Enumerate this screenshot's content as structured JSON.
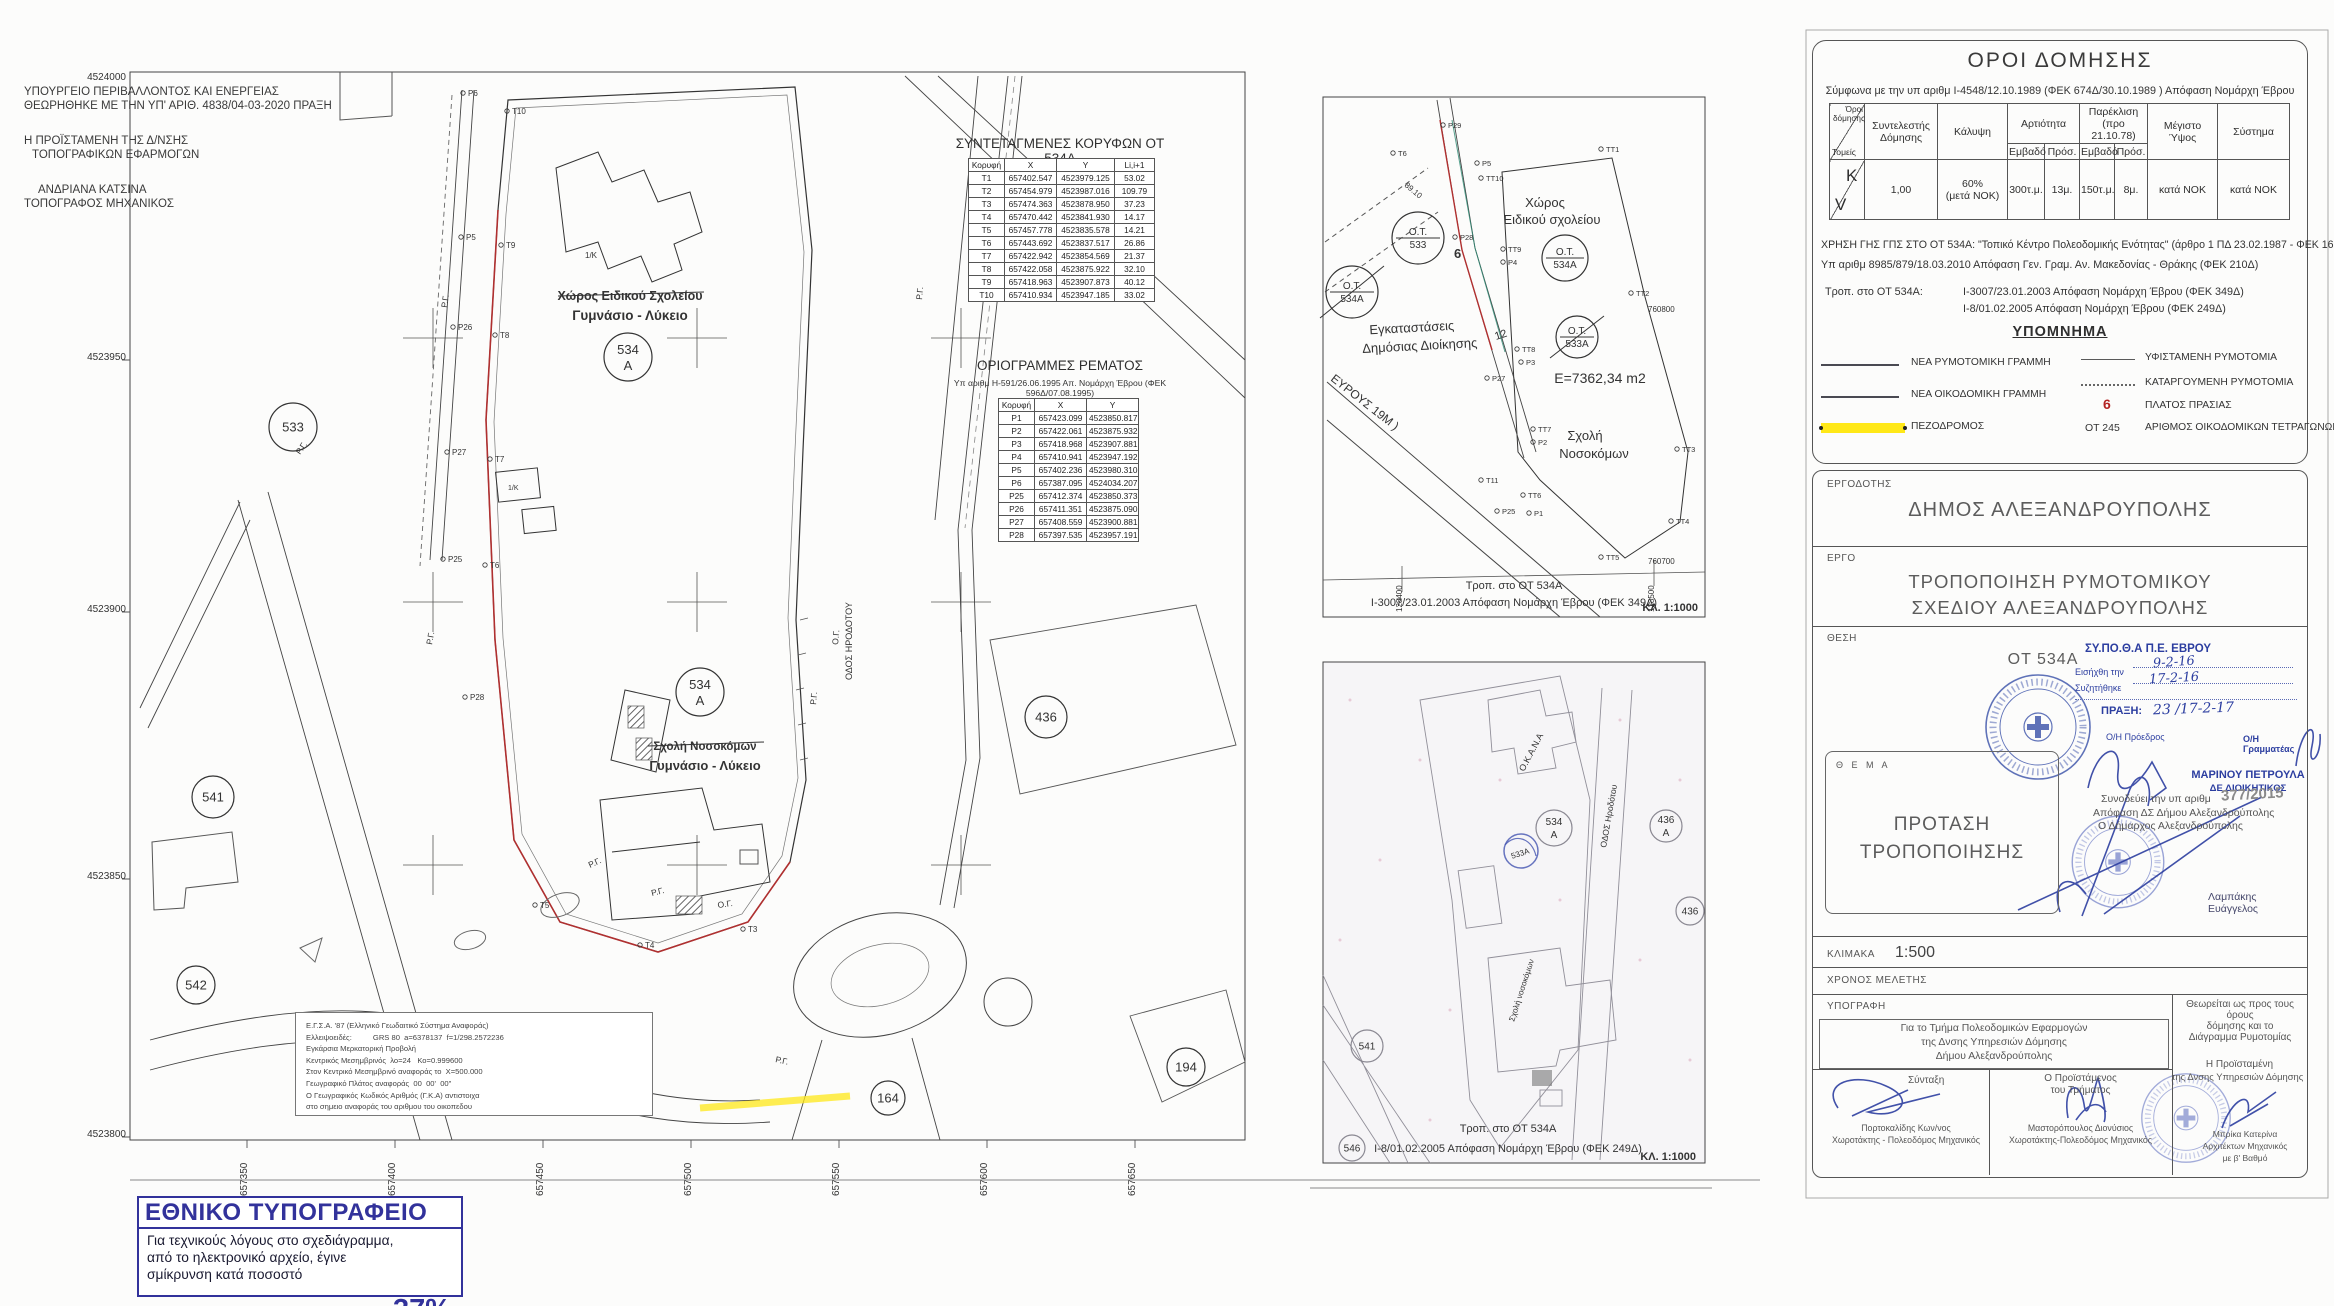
{
  "colors": {
    "accent_red": "#a82828",
    "stamp_blue": "#2c3ea0",
    "np_blue": "#32329b",
    "pezodromos_yellow": "#ffe818"
  },
  "approval": {
    "line1": "ΥΠΟΥΡΓΕΙΟ ΠΕΡΙΒΑΛΛΟΝΤΟΣ ΚΑΙ ΕΝΕΡΓΕΙΑΣ",
    "line2": "ΘΕΩΡΗΘΗΚΕ ΜΕ ΤΗΝ ΥΠ' ΑΡΙΘ. 4838/04-03-2020 ΠΡΑΞΗ",
    "role1": "Η ΠΡΟΪΣΤΑΜΕΝΗ ΤΗΣ Δ/ΝΣΗΣ",
    "role2": "ΤΟΠΟΓΡΑΦΙΚΩΝ ΕΦΑΡΜΟΓΩΝ",
    "name": "ΑΝΔΡΙΑΝΑ ΚΑΤΣΙΝΑ",
    "name_role": "ΤΟΠΟΓΡΑΦΟΣ ΜΗΧΑΝΙΚΟΣ"
  },
  "coord_table": {
    "title": "ΣΥΝΤΕΤΑΓΜΕΝΕΣ ΚΟΡΥΦΩΝ ΟΤ 534Α",
    "headers": [
      "Κορυφή",
      "X",
      "Y",
      "Li,i+1"
    ],
    "rows": [
      [
        "T1",
        "657402.547",
        "4523979.125",
        "53.02"
      ],
      [
        "T2",
        "657454.979",
        "4523987.016",
        "109.79"
      ],
      [
        "T3",
        "657474.363",
        "4523878.950",
        "37.23"
      ],
      [
        "T4",
        "657470.442",
        "4523841.930",
        "14.17"
      ],
      [
        "T5",
        "657457.778",
        "4523835.578",
        "14.21"
      ],
      [
        "T6",
        "657443.692",
        "4523837.517",
        "26.86"
      ],
      [
        "T7",
        "657422.942",
        "4523854.569",
        "21.37"
      ],
      [
        "T8",
        "657422.058",
        "4523875.922",
        "32.10"
      ],
      [
        "T9",
        "657418.963",
        "4523907.873",
        "40.12"
      ],
      [
        "T10",
        "657410.934",
        "4523947.185",
        "33.02"
      ]
    ]
  },
  "stream_table": {
    "title": "ΟΡΙΟΓΡΑΜΜΕΣ ΡΕΜΑΤΟΣ",
    "subtitle": "Υπ αριθμ Η-591/26.06.1995 Απ. Νομάρχη Έβρου  (ΦΕΚ 596Δ/07.08.1995)",
    "headers": [
      "Κορυφή",
      "X",
      "Y"
    ],
    "rows": [
      [
        "P1",
        "657423.099",
        "4523850.817"
      ],
      [
        "P2",
        "657422.061",
        "4523875.932"
      ],
      [
        "P3",
        "657418.968",
        "4523907.881"
      ],
      [
        "P4",
        "657410.941",
        "4523947.192"
      ],
      [
        "P5",
        "657402.236",
        "4523980.310"
      ],
      [
        "P6",
        "657387.095",
        "4524034.207"
      ],
      [
        "P25",
        "657412.374",
        "4523850.373"
      ],
      [
        "P26",
        "657411.351",
        "4523875.090"
      ],
      [
        "P27",
        "657408.559",
        "4523900.881"
      ],
      [
        "P28",
        "657397.535",
        "4523957.191"
      ]
    ]
  },
  "main_map": {
    "axis_left": [
      {
        "x": 126,
        "y": 80,
        "l": "4524000"
      },
      {
        "x": 126,
        "y": 360,
        "l": "4523950"
      },
      {
        "x": 126,
        "y": 612,
        "l": "4523900"
      },
      {
        "x": 126,
        "y": 879,
        "l": "4523850"
      },
      {
        "x": 126,
        "y": 1137,
        "l": "4523800"
      }
    ],
    "axis_bottom": [
      {
        "x": 247,
        "y": 1196,
        "l": "657350"
      },
      {
        "x": 395,
        "y": 1196,
        "l": "657400"
      },
      {
        "x": 543,
        "y": 1196,
        "l": "657450"
      },
      {
        "x": 691,
        "y": 1196,
        "l": "657500"
      },
      {
        "x": 839,
        "y": 1196,
        "l": "657550"
      },
      {
        "x": 987,
        "y": 1196,
        "l": "657600"
      },
      {
        "x": 1135,
        "y": 1196,
        "l": "657650"
      }
    ],
    "circles": [
      {
        "x": 293,
        "y": 427,
        "r": 24,
        "l1": "533"
      },
      {
        "x": 628,
        "y": 357,
        "r": 24,
        "l1": "534",
        "l2": "Α"
      },
      {
        "x": 700,
        "y": 692,
        "r": 24,
        "l1": "534",
        "l2": "Α"
      },
      {
        "x": 213,
        "y": 797,
        "r": 21,
        "l1": "541"
      },
      {
        "x": 1046,
        "y": 717,
        "r": 21,
        "l1": "436"
      },
      {
        "x": 1186,
        "y": 1067,
        "r": 19,
        "l1": "194"
      },
      {
        "x": 888,
        "y": 1098,
        "r": 17,
        "l1": "164"
      },
      {
        "x": 196,
        "y": 985,
        "r": 19,
        "l1": "542"
      }
    ],
    "points": [
      {
        "x": 468,
        "y": 96,
        "l": "P6"
      },
      {
        "x": 512,
        "y": 114,
        "l": "T10"
      },
      {
        "x": 466,
        "y": 240,
        "l": "P5"
      },
      {
        "x": 506,
        "y": 248,
        "l": "T9"
      },
      {
        "x": 458,
        "y": 330,
        "l": "P26"
      },
      {
        "x": 500,
        "y": 338,
        "l": "T8"
      },
      {
        "x": 452,
        "y": 455,
        "l": "P27"
      },
      {
        "x": 495,
        "y": 462,
        "l": "T7"
      },
      {
        "x": 448,
        "y": 562,
        "l": "P25"
      },
      {
        "x": 490,
        "y": 568,
        "l": "T6"
      },
      {
        "x": 470,
        "y": 700,
        "l": "P28"
      },
      {
        "x": 540,
        "y": 908,
        "l": "T5"
      },
      {
        "x": 645,
        "y": 948,
        "l": "T4"
      },
      {
        "x": 748,
        "y": 932,
        "l": "T3"
      }
    ],
    "rg_labels": [
      {
        "x": 447,
        "y": 308,
        "r": -82,
        "l": "Ρ.Γ."
      },
      {
        "x": 300,
        "y": 455,
        "r": -55,
        "l": "Ρ.Γ."
      },
      {
        "x": 432,
        "y": 645,
        "r": -80,
        "l": "Ρ.Γ."
      },
      {
        "x": 590,
        "y": 868,
        "r": -25,
        "l": "Ρ.Γ."
      },
      {
        "x": 652,
        "y": 896,
        "r": -14,
        "l": "Ρ.Γ."
      },
      {
        "x": 718,
        "y": 908,
        "r": -8,
        "l": "Ο.Γ."
      },
      {
        "x": 838,
        "y": 645,
        "r": -85,
        "l": "Ο.Γ."
      },
      {
        "x": 816,
        "y": 705,
        "r": -85,
        "l": "Ρ.Γ."
      },
      {
        "x": 922,
        "y": 300,
        "r": -85,
        "l": "Ρ.Γ."
      },
      {
        "x": 775,
        "y": 1062,
        "r": 12,
        "l": "Ρ.Γ."
      }
    ],
    "label_struck_top": "Χώρος Ειδικού Σχολείου",
    "label_red_top": "Γυμνάσιο - Λύκειο",
    "label_struck_mid": "Σχολή Νοσοκόμων",
    "label_red_mid": "Γυμνάσιο - Λύκειο",
    "street": "ΟΔΟΣ ΗΡΟΔΟΤΟΥ",
    "bld_label": "1/Κ",
    "egsa_lines": [
      "Ε.Γ.Σ.Α. '87 (Ελληνικό Γεωδαιτικό Σύστημα Αναφοράς)",
      "Ελλειψοειδές:          GRS 80  a=6378137  f=1/298.2572236",
      "Εγκάρσια Μερκατορική Προβολή",
      "Κεντρικός Μεσημβρινός  λο=24   Κο=0.999600",
      "Στον Κεντρικό Μεσημβρινό αναφοράς το  Χ=500.000",
      "Γεωγραφικό Πλάτος αναφοράς  00  00'  00\"",
      "Ο Γεωγραφικός Κωδικός Αριθμός (Γ.Κ.Α) αντιστοιχα",
      "στο σημειο αναφοράς του αριθμου του οικοπεδου"
    ]
  },
  "inset1": {
    "points": [
      {
        "x": 1448,
        "y": 128,
        "l": "P29"
      },
      {
        "x": 1398,
        "y": 156,
        "l": "T6"
      },
      {
        "x": 1482,
        "y": 166,
        "l": "P5"
      },
      {
        "x": 1486,
        "y": 181,
        "l": "TT10"
      },
      {
        "x": 1460,
        "y": 240,
        "l": "P28"
      },
      {
        "x": 1508,
        "y": 252,
        "l": "TT9"
      },
      {
        "x": 1508,
        "y": 265,
        "l": "P4"
      },
      {
        "x": 1522,
        "y": 352,
        "l": "TT8"
      },
      {
        "x": 1526,
        "y": 365,
        "l": "P3"
      },
      {
        "x": 1492,
        "y": 381,
        "l": "P27"
      },
      {
        "x": 1538,
        "y": 432,
        "l": "TT7"
      },
      {
        "x": 1538,
        "y": 445,
        "l": "P2"
      },
      {
        "x": 1486,
        "y": 483,
        "l": "T11"
      },
      {
        "x": 1502,
        "y": 514,
        "l": "P25"
      },
      {
        "x": 1534,
        "y": 516,
        "l": "P1"
      },
      {
        "x": 1528,
        "y": 498,
        "l": "TT6"
      },
      {
        "x": 1606,
        "y": 152,
        "l": "TT1"
      },
      {
        "x": 1636,
        "y": 296,
        "l": "TT2"
      },
      {
        "x": 1682,
        "y": 452,
        "l": "TT3"
      },
      {
        "x": 1676,
        "y": 524,
        "l": "TT4"
      },
      {
        "x": 1606,
        "y": 560,
        "l": "TT5"
      }
    ],
    "circles": [
      {
        "x": 1352,
        "y": 292,
        "r": 26,
        "l1": "Ο.Τ.",
        "l2": "534Α",
        "split": true,
        "strike": true
      },
      {
        "x": 1418,
        "y": 238,
        "r": 26,
        "l1": "Ο.Τ.",
        "l2": "533",
        "split": true
      },
      {
        "x": 1565,
        "y": 258,
        "r": 23,
        "l1": "Ο.Τ.",
        "l2": "534Α",
        "split": true
      },
      {
        "x": 1577,
        "y": 337,
        "r": 21,
        "l1": "Ο.Τ.",
        "l2": "533Α",
        "split": true,
        "strike": true
      }
    ],
    "labels": {
      "xoros1": "Χώρος",
      "xoros2": "Ειδικού σχολείου",
      "egk1": "Εγκαταστάσεις",
      "egk2": "Δημόσιας Διοίκησης",
      "area": "Ε=7362,34 m2",
      "sxoli1": "Σχολή",
      "sxoli2": "Νοσοκόμων",
      "street": "ΕΥΡΟΥΣ 19Μ )",
      "n6": "6",
      "n12": "12",
      "dim": "89.10",
      "c1": "760800",
      "c2": "760700"
    },
    "axis": [
      {
        "x": 1402,
        "y": 612,
        "l": "128400"
      },
      {
        "x": 1654,
        "y": 612,
        "l": "128500"
      }
    ],
    "cap1": "Τροπ. στο ΟΤ 534Α",
    "cap2": "Ι-3007/23.01.2003 Απόφαση Νομάρχη Έβρου (ΦΕΚ 349Δ)",
    "scale": "ΚΛ. 1:1000"
  },
  "inset2": {
    "circles": [
      {
        "x": 1554,
        "y": 828,
        "r": 18,
        "l1": "534",
        "l2": "Α"
      },
      {
        "x": 1666,
        "y": 826,
        "r": 16,
        "l1": "436",
        "l2": "Α"
      },
      {
        "x": 1690,
        "y": 911,
        "r": 14,
        "l1": "436"
      },
      {
        "x": 1367,
        "y": 1046,
        "r": 16,
        "l1": "541"
      },
      {
        "x": 1352,
        "y": 1148,
        "r": 13,
        "l1": "546"
      }
    ],
    "stamp": "533Α",
    "labels": {
      "okana": "Ο.Κ.Α.Ν.Α",
      "sxoli": "Σχολή νοσοκόμων",
      "street": "ΟΔΟΣ Ηροδότου"
    },
    "cap1": "Τροπ. στο ΟΤ 534Α",
    "cap2": "Ι-8/01.02.2005 Απόφαση Νομάρχη Έβρου (ΦΕΚ 249Δ)",
    "scale": "ΚΛ. 1:1000"
  },
  "oroi": {
    "title": "ΟΡΟΙ ΔΟΜΗΣΗΣ",
    "subtitle": "Σύμφωνα με την υπ αριθμ Ι-4548/12.10.1989 (ΦΕΚ 674Δ/30.10.1989 ) Απόφαση Νομάρχη Έβρου",
    "corner_top": "Όροι δόμησης",
    "corner_bottom": "Τομείς",
    "col_sd": "Συντελεστής Δόμησης",
    "col_kalypsi": "Κάλυψη",
    "col_art": "Αρτιότητα",
    "col_par1": "Παρέκλιση",
    "col_par2": "(προ 21.10.78)",
    "sub_emv": "Εμβαδό",
    "sub_pros": "Πρόσ.",
    "col_ypsos": "Μέγιστο Ύψος",
    "col_systima": "Σύστημα",
    "zone_k": "K",
    "zone_v": "V",
    "val_sd": "1,00",
    "val_kal1": "60%",
    "val_kal2": "(μετά ΝΟΚ)",
    "val_emv": "300τ.μ.",
    "val_pros": "13μ.",
    "val_emv2": "150τ.μ.",
    "val_pros2": "8μ.",
    "val_ypsos": "κατά ΝΟΚ",
    "val_systima": "κατά ΝΟΚ",
    "note1": "ΧΡΗΣΗ ΓΗΣ ΓΠΣ ΣΤΟ ΟΤ 534Α: \"Τοπικό Κέντρο Πολεοδομικής Ενότητας\" (άρθρο 1 ΠΔ 23.02.1987 - ΦΕΚ 166Α)",
    "note2": "Υπ αριθμ 8985/879/18.03.2010 Απόφαση Γεν. Γραμ. Αν. Μακεδονίας - Θράκης (ΦΕΚ 210Δ)",
    "trop_label": "Τροπ. στο ΟΤ 534Α:",
    "trop1": "Ι-3007/23.01.2003 Απόφαση Νομάρχη Έβρου (ΦΕΚ 349Δ)",
    "trop2": "Ι-8/01.02.2005 Απόφαση Νομάρχη Έβρου (ΦΕΚ 249Δ)"
  },
  "legend": {
    "title": "ΥΠΟΜΝΗΜΑ",
    "items_left": [
      "ΝΕΑ ΡΥΜΟΤΟΜΙΚΗ ΓΡΑΜΜΗ",
      "ΝΕΑ ΟΙΚΟΔΟΜΙΚΗ ΓΡΑΜΜΗ",
      "ΠΕΖΟΔΡΟΜΟΣ"
    ],
    "items_right": [
      "ΥΦΙΣΤΑΜΕΝΗ ΡΥΜΟΤΟΜΙΑ",
      "ΚΑΤΑΡΓΟΥΜΕΝΗ ΡΥΜΟΤΟΜΙΑ",
      "ΠΛΑΤΟΣ ΠΡΑΣΙΑΣ",
      "ΑΡΙΘΜΟΣ ΟΙΚΟΔΟΜΙΚΩΝ ΤΕΤΡΑΓΩΝΩΝ"
    ],
    "sym_prasia": "6",
    "sym_ot": "ΟΤ 245"
  },
  "titleblock": {
    "ergodotis_label": "ΕΡΓΟΔΟΤΗΣ",
    "ergodotis": "ΔΗΜΟΣ ΑΛΕΞΑΝΔΡΟΥΠΟΛΗΣ",
    "ergo_label": "ΕΡΓΟ",
    "ergo1": "ΤΡΟΠΟΠΟΙΗΣΗ ΡΥΜΟΤΟΜΙΚΟΥ",
    "ergo2": "ΣΧΕΔΙΟΥ ΑΛΕΞΑΝΔΡΟΥΠΟΛΗΣ",
    "thesi_label": "ΘΕΣΗ",
    "thesi": "ΟΤ 534Α",
    "sypotha": "ΣΥ.ΠΟ.Θ.Α  Π.Ε. ΕΒΡΟΥ",
    "in_label": "Εισήχθη την",
    "in_date": "9-2-16",
    "dis_label": "Συζητήθηκε",
    "dis_date": "17-2-16",
    "praxi_label": "ΠΡΑΞΗ:",
    "praxi_value": "23 /17-2-17",
    "proedros": "Ο/Η Πρόεδρος",
    "grammateas": "Ο/Η Γραμματέας",
    "marinou": "ΜΑΡΙΝΟΥ ΠΕΤΡΟΥΛΑ",
    "marinou_role": "ΔΕ ΔΙΟΙΚΗΤΙΚΟΣ",
    "synodeuei": "Συνοδεύει την υπ αριθμ",
    "synodeuei_num": "377/2015",
    "synodeuei2": "Απόφαση ΔΣ Δήμου Αλεξανδρούπολης",
    "synodeuei3": "Ο Δήμαρχος Αλεξανδρούπολης",
    "mayor": "Λαμπάκης Ευάγγελος",
    "thema_label": "Θ Ε Μ Α",
    "thema1": "ΠΡΟΤΑΣΗ",
    "thema2": "ΤΡΟΠΟΠΟΙΗΣΗΣ",
    "klimaka_label": "ΚΛΙΜΑΚΑ",
    "klimaka": "1:500",
    "xronos_label": "ΧΡΟΝΟΣ ΜΕΛΕΤΗΣ",
    "ypografi_label": "ΥΠΟΓΡΑΦΗ",
    "theoreitai1": "Θεωρείται ως προς τους όρους",
    "theoreitai2": "δόμησης και το",
    "theoreitai3": "Διάγραμμα Ρυμοτομίας",
    "gia1": "Για το Τμήμα Πολεοδομικών Εφαρμογών",
    "gia2": "της Δνσης Υπηρεσιών Δόμησης",
    "gia3": "Δήμου Αλεξανδρούπολης",
    "syntaxi": "Σύνταξη",
    "syntaxi_name": "Πορτοκαλίδης Κων/νος",
    "syntaxi_role": "Χωροτάκτης -  Πολεοδόμος Μηχανικός",
    "proist1": "Ο Προϊστάμενος",
    "proist2": "του Τμήματος",
    "proist_name": "Μαστορόπουλος Διονύσιος",
    "proist_role": "Χωροτάκτης-Πολεοδόμος Μηχανικός",
    "dief1": "Η Προϊσταμένη",
    "dief2": "της Δνσης Υπηρεσιών Δόμησης",
    "dief_name": "Μπρίκα Κατερίνα",
    "dief_role1": "Αρχιτέκτων Μηχανικός",
    "dief_role2": "με β' Βαθμό"
  },
  "np_stamp": {
    "title": "ΕΘΝΙΚΟ ΤΥΠΟΓΡΑΦΕΙΟ",
    "l1": "Για  τεχνικούς  λόγους  στο  σχεδιάγραμμα,",
    "l2": "από το ηλεκτρονικό αρχείο, έγινε",
    "l3": "σμίκρυνση κατά ποσοστό",
    "percent": "37%"
  }
}
